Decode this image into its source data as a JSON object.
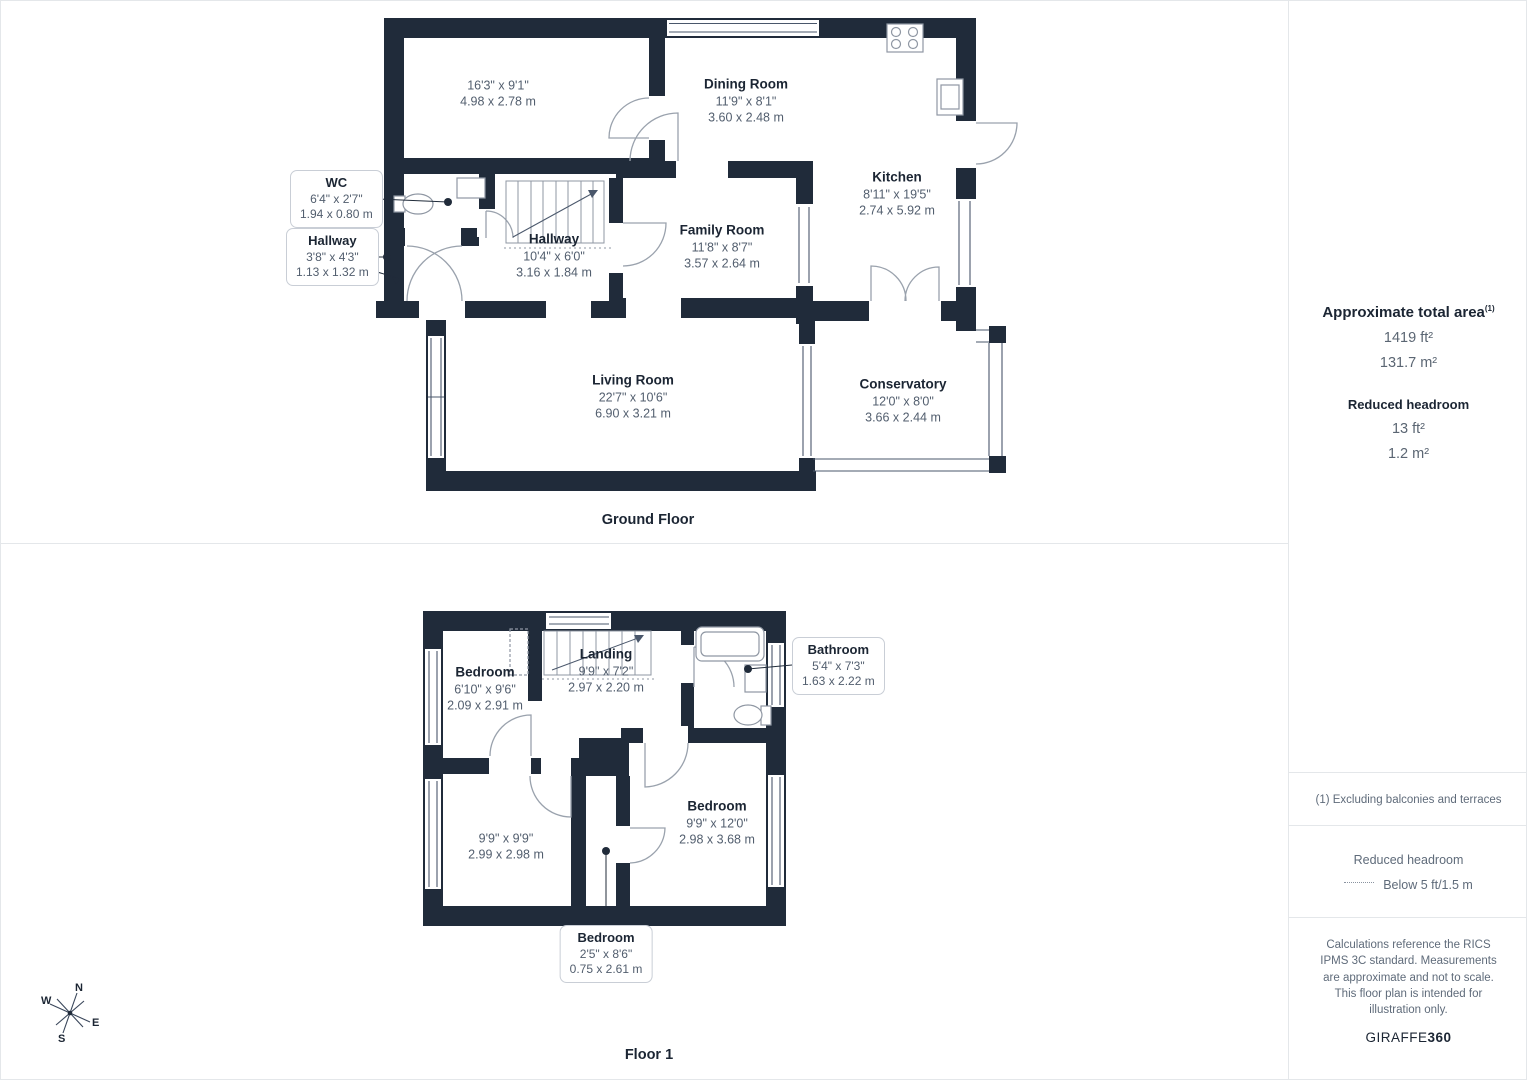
{
  "ground_floor": {
    "title": "Ground Floor",
    "rooms": {
      "garage": {
        "dims_ft": "16'3\" x 9'1\"",
        "dims_m": "4.98 x 2.78 m"
      },
      "dining": {
        "name": "Dining Room",
        "dims_ft": "11'9\" x 8'1\"",
        "dims_m": "3.60 x 2.48 m"
      },
      "kitchen": {
        "name": "Kitchen",
        "dims_ft": "8'11\" x 19'5\"",
        "dims_m": "2.74 x 5.92 m"
      },
      "family": {
        "name": "Family Room",
        "dims_ft": "11'8\" x 8'7\"",
        "dims_m": "3.57 x 2.64 m"
      },
      "hallway_main": {
        "name": "Hallway",
        "dims_ft": "10'4\" x 6'0\"",
        "dims_m": "3.16 x 1.84 m"
      },
      "living": {
        "name": "Living Room",
        "dims_ft": "22'7\" x 10'6\"",
        "dims_m": "6.90 x 3.21 m"
      },
      "conservatory": {
        "name": "Conservatory",
        "dims_ft": "12'0\" x 8'0\"",
        "dims_m": "3.66 x 2.44 m"
      }
    },
    "callouts": {
      "wc": {
        "name": "WC",
        "dims_ft": "6'4\" x 2'7\"",
        "dims_m": "1.94 x 0.80 m"
      },
      "hallway_small": {
        "name": "Hallway",
        "dims_ft": "3'8\" x 4'3\"",
        "dims_m": "1.13 x 1.32 m"
      }
    }
  },
  "floor1": {
    "title": "Floor 1",
    "rooms": {
      "bedroom_tl": {
        "name": "Bedroom",
        "dims_ft": "6'10\" x 9'6\"",
        "dims_m": "2.09 x 2.91 m"
      },
      "landing": {
        "name": "Landing",
        "dims_ft": "9'9\" x 7'2\"",
        "dims_m": "2.97 x 2.20 m"
      },
      "bedroom_bl": {
        "dims_ft": "9'9\" x 9'9\"",
        "dims_m": "2.99 x 2.98 m"
      },
      "bedroom_br": {
        "name": "Bedroom",
        "dims_ft": "9'9\" x 12'0\"",
        "dims_m": "2.98 x 3.68 m"
      }
    },
    "callouts": {
      "bathroom": {
        "name": "Bathroom",
        "dims_ft": "5'4\" x 7'3\"",
        "dims_m": "1.63 x 2.22 m"
      },
      "bedroom_small": {
        "name": "Bedroom",
        "dims_ft": "2'5\" x 8'6\"",
        "dims_m": "0.75 x 2.61 m"
      }
    }
  },
  "compass": {
    "n": "N",
    "e": "E",
    "s": "S",
    "w": "W"
  },
  "sidebar": {
    "total_area_title": "Approximate total area",
    "total_area_sup": "(1)",
    "total_area_ft": "1419 ft²",
    "total_area_m": "131.7 m²",
    "reduced_headroom_title": "Reduced headroom",
    "reduced_headroom_ft": "13 ft²",
    "reduced_headroom_m": "1.2 m²",
    "note_exclusions": "(1) Excluding balconies and terraces",
    "legend_title": "Reduced headroom",
    "legend_below": "Below 5 ft/1.5 m",
    "disclaimer": "Calculations reference the RICS IPMS 3C standard. Measurements are approximate and not to scale. This floor plan is intended for illustration only.",
    "brand_name": "GIRAFFE",
    "brand_suffix": "360"
  },
  "colors": {
    "wall": "#202b3a",
    "text_dark": "#1b2533",
    "text_dim": "#525e6e",
    "divider": "#e4e7ea"
  }
}
